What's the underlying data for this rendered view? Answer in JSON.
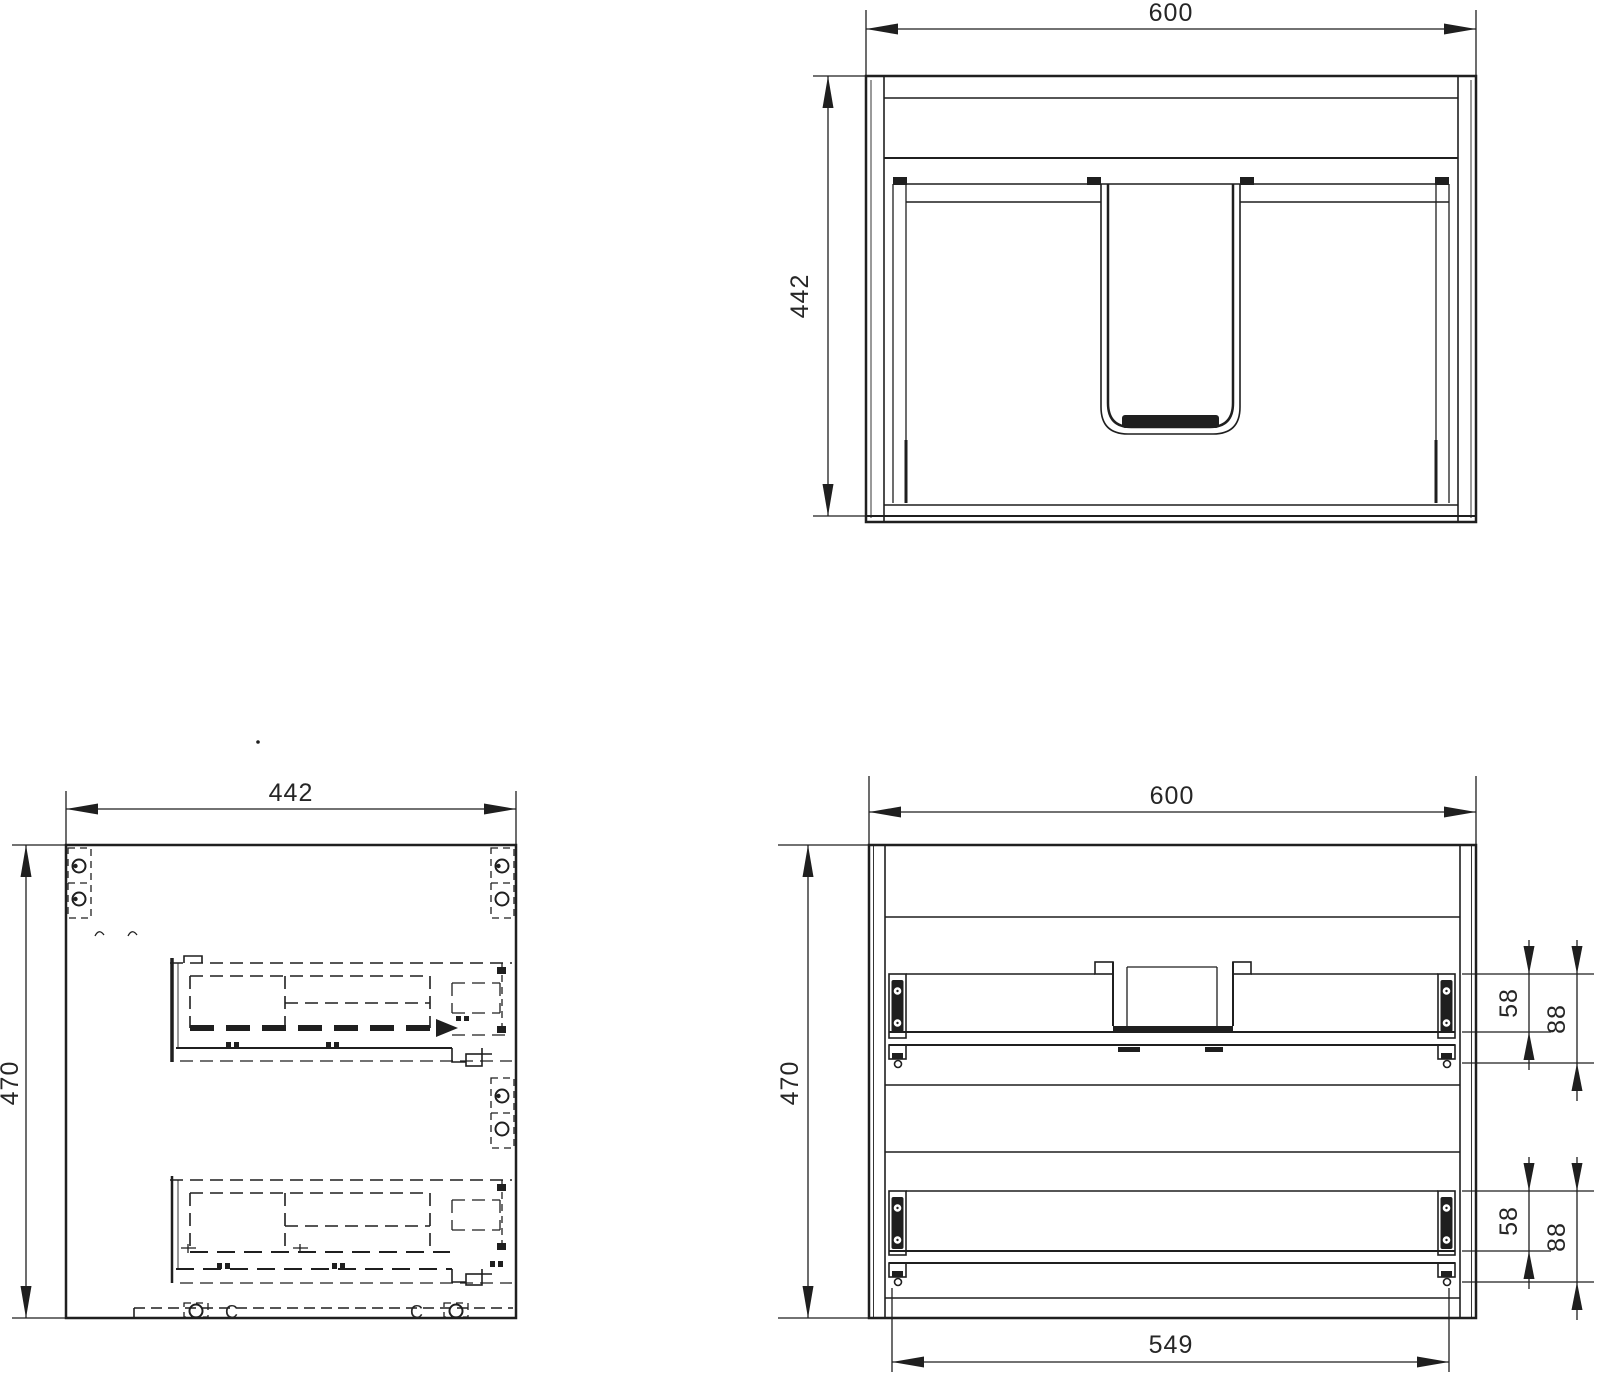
{
  "drawing": {
    "type": "cabinet-technical-drawing",
    "views": {
      "plan": {
        "width": "600",
        "depth": "442"
      },
      "side": {
        "depth": "442",
        "height": "470"
      },
      "front": {
        "width": "600",
        "height": "470",
        "inner_width": "549",
        "upper_drawer": {
          "rail_height": "58",
          "assembly_height": "88"
        },
        "lower_drawer": {
          "rail_height": "58",
          "assembly_height": "88"
        }
      }
    },
    "annotations": {
      "clip_letter": "C"
    },
    "colors": {
      "line": "#1f1f1f",
      "background": "#ffffff"
    }
  }
}
